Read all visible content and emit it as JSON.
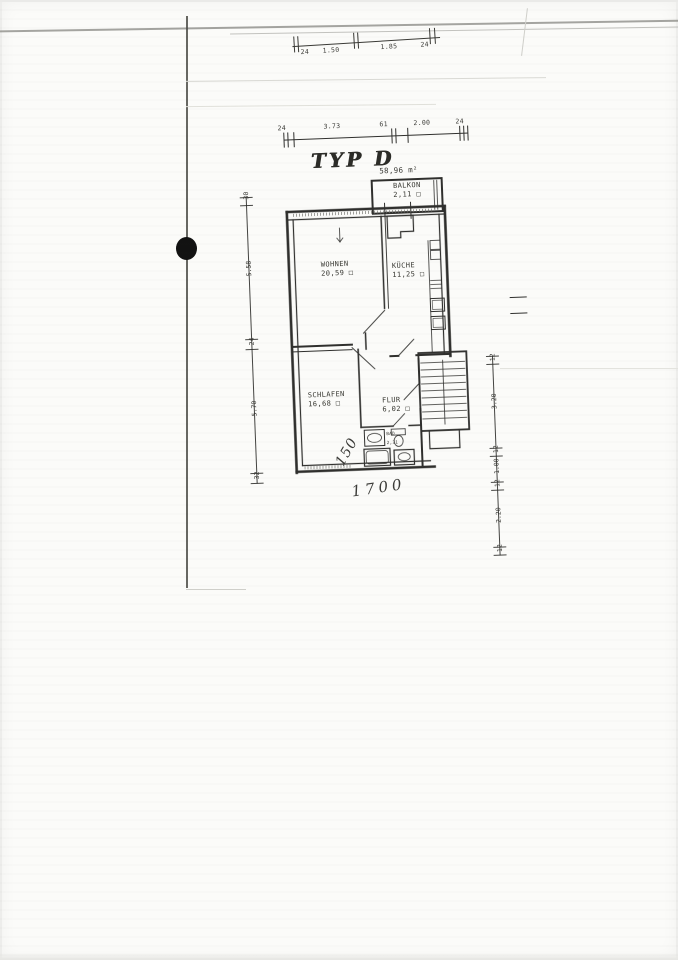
{
  "scan": {
    "title": "TYP D",
    "total_area": "58,96 m²",
    "handwriting": {
      "diagonal_note": "150",
      "bottom_note": "1700"
    },
    "rooms": [
      {
        "name": "BALKON",
        "area": "2,11 □"
      },
      {
        "name": "WOHNEN",
        "area": "20,59 □"
      },
      {
        "name": "KÜCHE",
        "area": "11,25 □"
      },
      {
        "name": "SCHLAFEN",
        "area": "16,68 □"
      },
      {
        "name": "FLUR",
        "area": "6,02 □"
      },
      {
        "name": "BAD",
        "area": "2,31"
      }
    ],
    "dim_chains": {
      "page_top": [
        "24",
        "1.50",
        "1.85",
        "24"
      ],
      "plan_top": [
        "24",
        "3.73",
        "61",
        "2.00",
        "24"
      ],
      "left": [
        "30",
        "5.58",
        "24",
        "5.70",
        "32"
      ],
      "right": [
        "12",
        "3.20",
        "12",
        "1.00",
        "12",
        "2.20",
        "12"
      ]
    },
    "colors": {
      "ink": "#2f2f2d",
      "paper": "#fbfbf9",
      "scan_line": "#8f8f8a"
    }
  }
}
